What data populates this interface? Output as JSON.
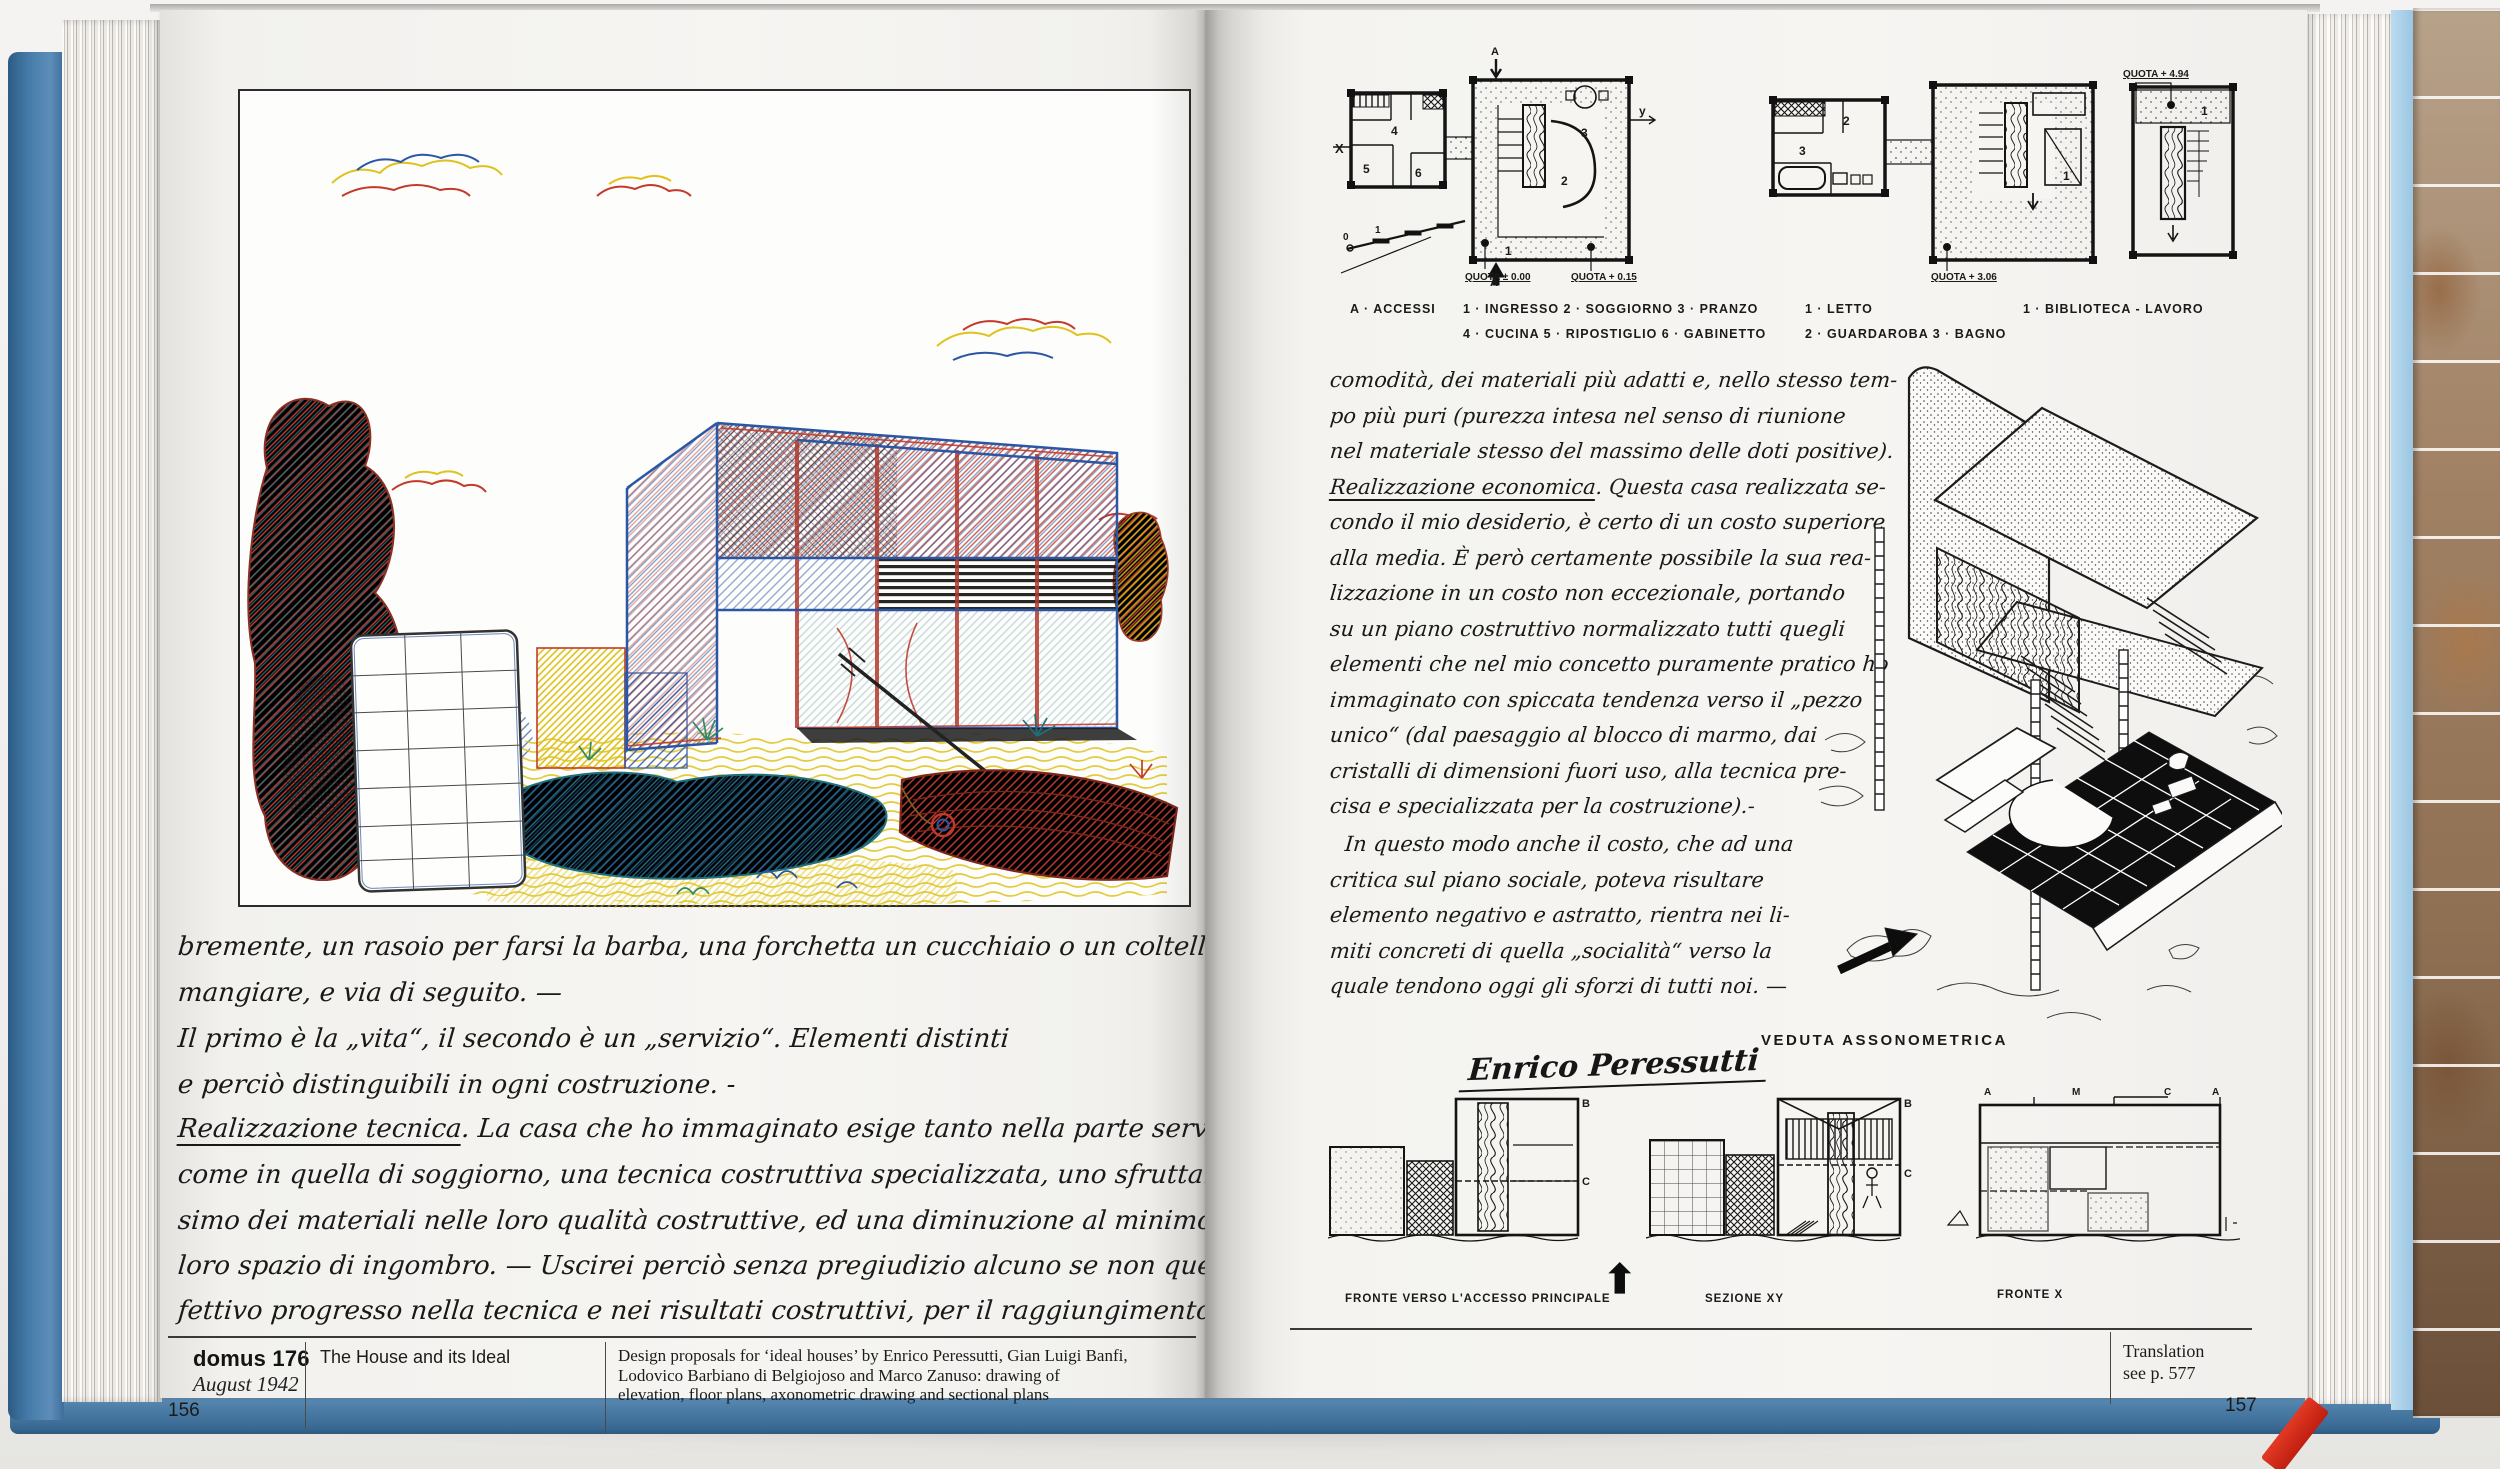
{
  "book": {
    "left_page": {
      "handwriting": {
        "l1": "bremente, un rasoio per farsi la barba, una forchetta un cucchiaio o un coltello per",
        "l2": "mangiare, e via di seguito. —",
        "l3": "Il primo è la „vita“, il secondo è un „servizio“. Elementi distinti",
        "l4": "e perciò distinguibili in ogni costruzione. -",
        "l5u": "Realizzazione tecnica",
        "l5rest": ". La casa che ho immaginato esige tanto nella parte servizi",
        "l6": "come in quella di soggiorno, una tecnica costruttiva specializzata, uno sfruttamento mas-",
        "l7": "simo dei materiali nelle loro qualità costruttive, ed una diminuzione al minimo del",
        "l8": "loro spazio di ingombro. — Uscirei perciò senza pregiudizio alcuno se non quello di un ef-",
        "l9": "fettivo progresso nella tecnica e nei risultati costruttivi, per il raggiungimento di una reale"
      },
      "footer": {
        "journal": "domus 176",
        "date": "August 1942",
        "page_number": "156",
        "article_title": "The House and its Ideal",
        "caption_l1": "Design proposals for ‘ideal houses’ by Enrico Peressutti, Gian Luigi Banfi,",
        "caption_l2": "Lodovico Barbiano di Belgiojoso and Marco Zanuso: drawing of",
        "caption_l3": "elevation, floor plans, axonometric drawing and sectional plans"
      }
    },
    "right_page": {
      "plans": {
        "quota_000": "QUOTA ± 0.00",
        "quota_015": "QUOTA + 0.15",
        "quota_306": "QUOTA + 3.06",
        "quota_494": "QUOTA + 4.94",
        "axis_x": "X",
        "axis_y": "y",
        "axis_a_top": "A",
        "axis_a_bottom": "A",
        "scale_0": "0",
        "scale_1": "1",
        "room_numbers": [
          "1",
          "2",
          "3",
          "4",
          "5",
          "6"
        ]
      },
      "legend": {
        "col1a": "A · ACCESSI",
        "col1b": "1 · INGRESSO   2 · SOGGIORNO   3 · PRANZO",
        "col1c": "4 · CUCINA   5 · RIPOSTIGLIO   6 · GABINETTO",
        "col2a": "1 ·  LETTO",
        "col2b": "2 ·  GUARDAROBA    3 ·  BAGNO",
        "col3a": "1 · BIBLIOTECA - LAVORO"
      },
      "handwriting": {
        "r1": "comodità, dei materiali più adatti e, nello stesso tem-",
        "r2": "po più puri (purezza intesa nel senso di riunione",
        "r3": "nel materiale stesso del massimo delle doti positive).",
        "r4u": "Realizzazione economica",
        "r4rest": ". Questa casa realizzata se-",
        "r5": "condo il mio desiderio, è certo di un costo superiore",
        "r6": "alla media. È però certamente possibile la sua rea-",
        "r7": "lizzazione in un costo non eccezionale, portando",
        "r8": "su un piano costruttivo normalizzato tutti quegli",
        "r9": "elementi che nel mio concetto puramente pratico ho",
        "r10": "immaginato con spiccata tendenza verso il „pezzo",
        "r11": "unico“ (dal paesaggio al blocco di marmo, dai",
        "r12": "cristalli di dimensioni fuori uso, alla tecnica pre-",
        "r13": "cisa e specializzata per la costruzione).-",
        "r14": "In questo modo anche il costo, che ad una",
        "r15": "critica sul piano sociale, poteva risultare",
        "r16": "elemento negativo e astratto, rientra nei li-",
        "r17": "miti concreti di quella „socialità“ verso la",
        "r18": "quale tendono oggi gli sforzi di tutti noi. —"
      },
      "signature": "Enrico Peressutti",
      "axo_label": "VEDUTA ASSONOMETRICA",
      "sections": {
        "s1": "FRONTE VERSO L'ACCESSO PRINCIPALE",
        "s2": "SEZIONE XY",
        "s3": "FRONTE X",
        "arrow_up": "⬆",
        "letters": {
          "a": "A",
          "b": "B",
          "c": "C",
          "m": "M"
        }
      },
      "footer": {
        "translation_l1": "Translation",
        "translation_l2": "see p. 577",
        "page_number": "157"
      }
    },
    "colors": {
      "cover_blue": "#4d7fa9",
      "ribbon_red": "#d5291b",
      "sketch_red": "#c3392b",
      "sketch_blue": "#2b56a4",
      "sketch_yellow": "#dfc21d",
      "sketch_green": "#2e8b5f",
      "ink": "#1a1a1a"
    }
  }
}
